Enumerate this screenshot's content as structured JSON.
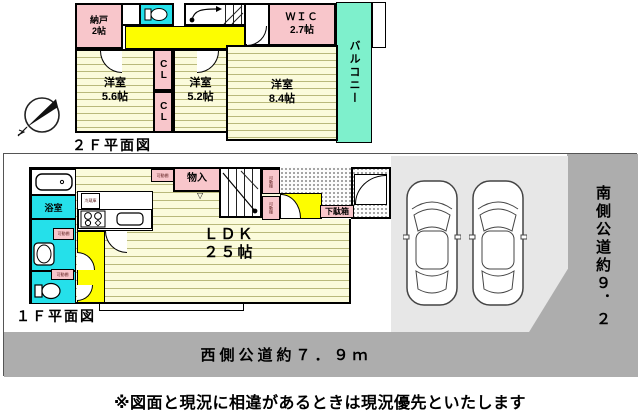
{
  "floor2": {
    "plan_label": "２Ｆ平面図",
    "nando_name": "納戸",
    "nando_size": "2帖",
    "wic_name": "ＷＩＣ",
    "wic_size": "2.7帖",
    "balcony": "バルコニー",
    "bed1_name": "洋室",
    "bed1_size": "5.6帖",
    "bed2_name": "洋室",
    "bed2_size": "5.2帖",
    "bed3_name": "洋室",
    "bed3_size": "8.4帖",
    "cl_top": "CL",
    "cl_bottom": "CL"
  },
  "floor1": {
    "plan_label": "１Ｆ平面図",
    "ldk_name": "ＬＤＫ",
    "ldk_size": "２５帖",
    "bath": "浴室",
    "monoire": "物入",
    "getabako": "下駄箱",
    "fridge": "冷蔵庫",
    "shelf": "可動棚"
  },
  "site": {
    "south_road": "南側公道約９．２ｍ",
    "west_road": "西側公道約７．９ｍ"
  },
  "disclaimer": "※図面と現況に相違があるときは現況優先といたします",
  "colors": {
    "room_pink": "#f8c6cb",
    "wet_cyan": "#25e0ea",
    "hall_yellow": "#fdfd00",
    "balcony_mint": "#7ef0cc",
    "room_cream": "#fbfbdc",
    "stripe": "#b9b97c",
    "parking_gray": "#e7e7e7",
    "road_gray": "#adadad"
  }
}
